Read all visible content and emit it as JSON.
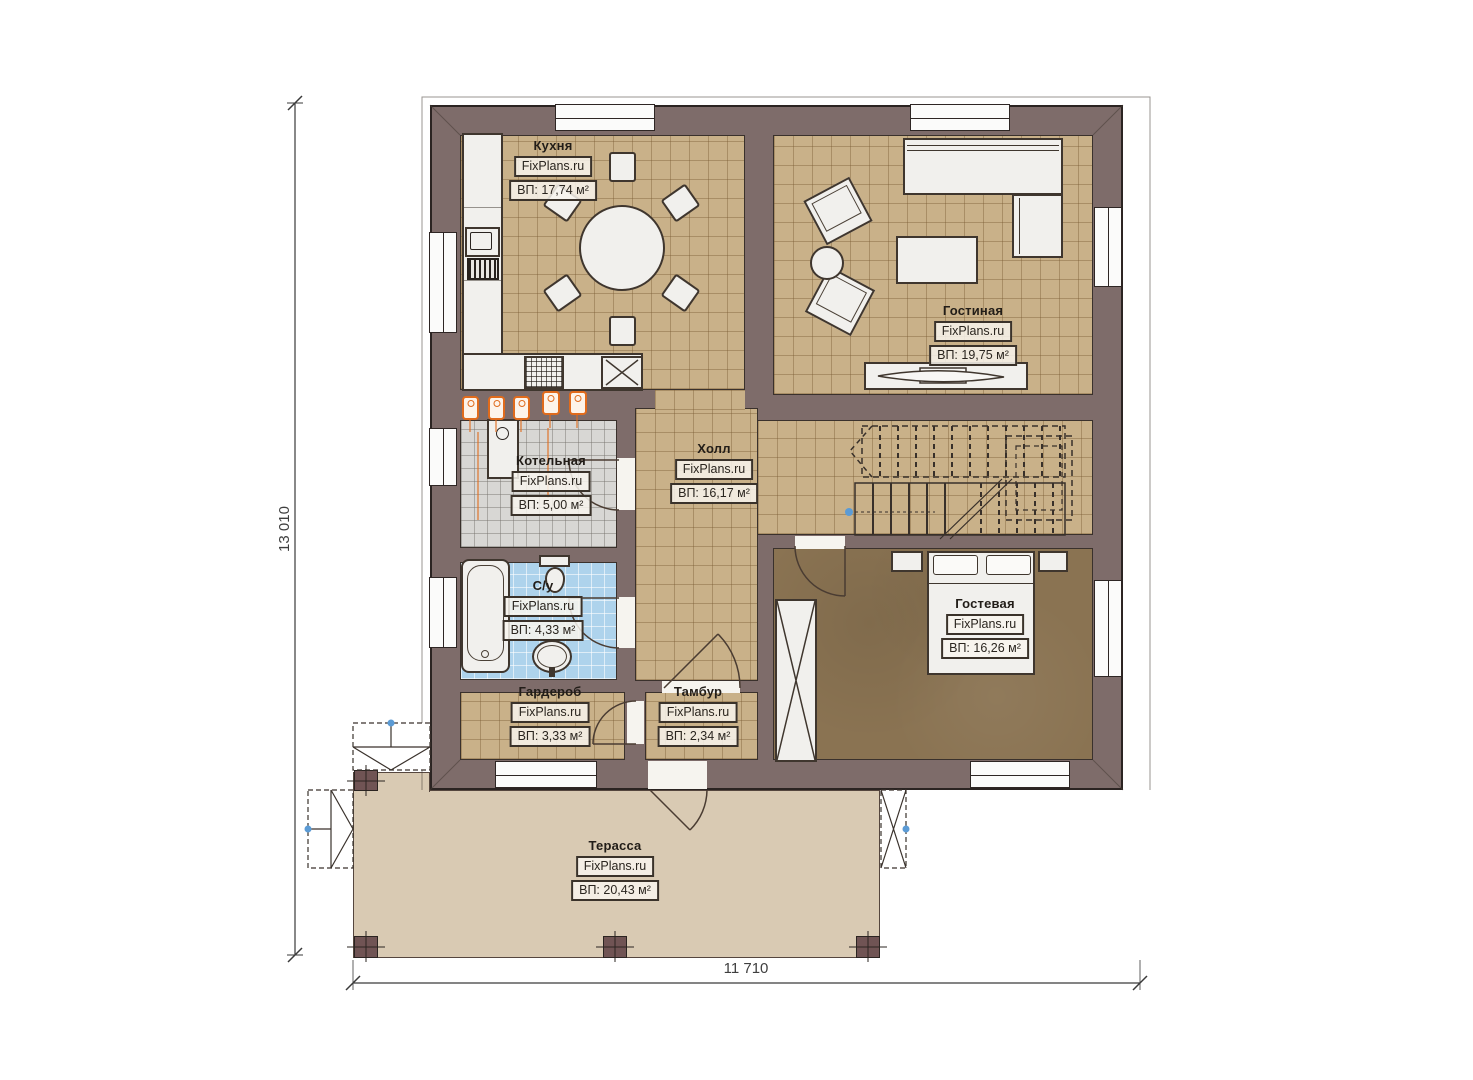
{
  "meta": {
    "type": "floor-plan",
    "language": "ru"
  },
  "brand": "FixPlans.ru",
  "dimensions": {
    "vertical": "13 010",
    "horizontal": "11 710"
  },
  "rooms": [
    {
      "name": "Кухня",
      "brand": "FixPlans.ru",
      "area": "ВП: 17,74 м²"
    },
    {
      "name": "Гостиная",
      "brand": "FixPlans.ru",
      "area": "ВП: 19,75 м²"
    },
    {
      "name": "Котельная",
      "brand": "FixPlans.ru",
      "area": "ВП: 5,00 м²"
    },
    {
      "name": "Холл",
      "brand": "FixPlans.ru",
      "area": "ВП: 16,17 м²"
    },
    {
      "name": "С/у",
      "brand": "FixPlans.ru",
      "area": "ВП: 4,33 м²"
    },
    {
      "name": "Гардероб",
      "brand": "FixPlans.ru",
      "area": "ВП: 3,33 м²"
    },
    {
      "name": "Тамбур",
      "brand": "FixPlans.ru",
      "area": "ВП: 2,34 м²"
    },
    {
      "name": "Гостевая",
      "brand": "FixPlans.ru",
      "area": "ВП: 16,26 м²"
    },
    {
      "name": "Терасса",
      "brand": "FixPlans.ru",
      "area": "ВП: 20,43 м²"
    }
  ],
  "colors": {
    "wall": "#7e6c6a",
    "tile_floor": "#c9b189",
    "boiler_floor": "#d8d7d4",
    "bathroom_floor": "#aed3ec",
    "guest_floor": "#8a7352",
    "terrace_floor": "#d9cab3",
    "accent_orange": "#e06b1c",
    "post": "#705454"
  }
}
